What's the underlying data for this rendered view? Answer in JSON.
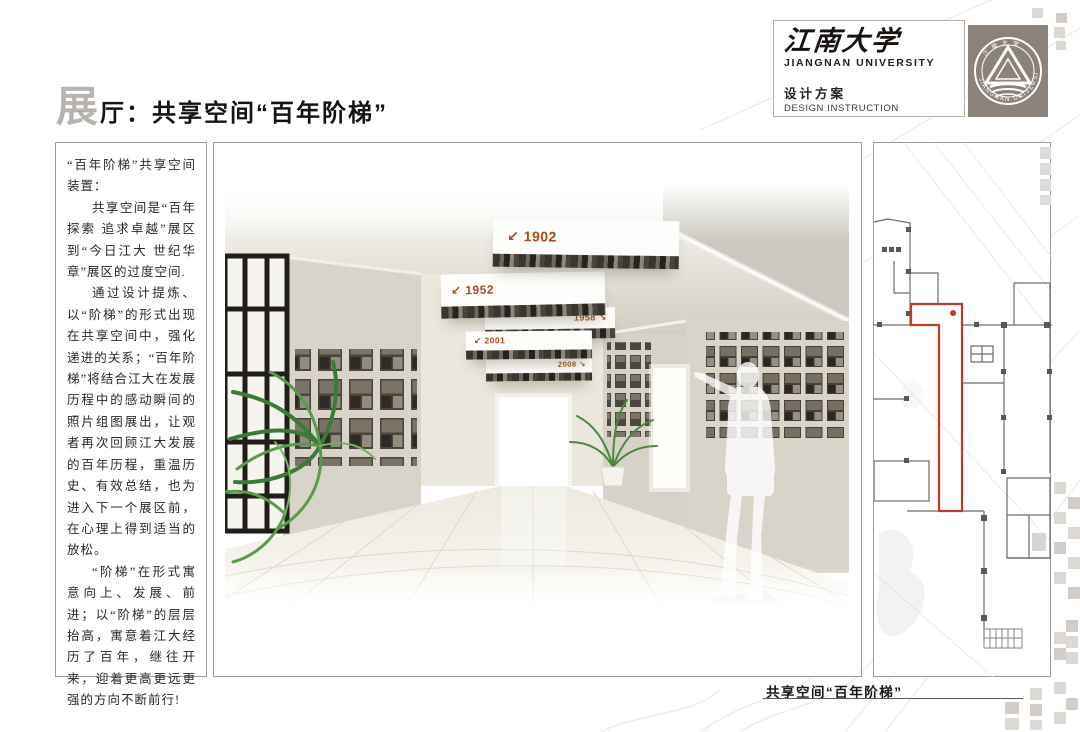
{
  "header": {
    "university_calligraphy": "江南大学",
    "university_en": "JIANGNAN UNIVERSITY",
    "doc_type_zh": "设计方案",
    "doc_type_en": "DESIGN INSTRUCTION",
    "badge_text": "JIANGNAN UNIVERSITY",
    "badge_top_text": "江南大学"
  },
  "title": {
    "lead_char": "展",
    "rest": "厅：共享空间“百年阶梯”"
  },
  "sidebar": {
    "paragraphs": [
      "“百年阶梯”共享空间装置：",
      "共享空间是“百年探索 追求卓越”展区到“今日江大 世纪华章”展区的过度空间.",
      "通过设计提炼、以“阶梯”的形式出现在共享空间中，强化递进的关系；“百年阶梯”将结合江大在发展历程中的感动瞬间的照片组图展出，让观者再次回顾江大发展的百年历程，重温历史、有效总结，也为进入下一个展区前，在心理上得到适当的放松。",
      "“阶梯”在形式寓意向上、发展、前进；以“阶梯”的层层抬高，寓意着江大经历了百年，继往开来，迎着更高更远更强的方向不断前行!"
    ]
  },
  "rendering": {
    "year_panels": [
      {
        "label": "↙ 1902"
      },
      {
        "label": "↙ 1952"
      },
      {
        "label": "1958 ↘"
      },
      {
        "label": "↙ 2001"
      },
      {
        "label": "2008 ↘"
      }
    ],
    "accent_color": "#a84b1f"
  },
  "floor_plan": {
    "highlight_color": "#c23b2a"
  },
  "footer": {
    "caption": "共享空间“百年阶梯”"
  }
}
